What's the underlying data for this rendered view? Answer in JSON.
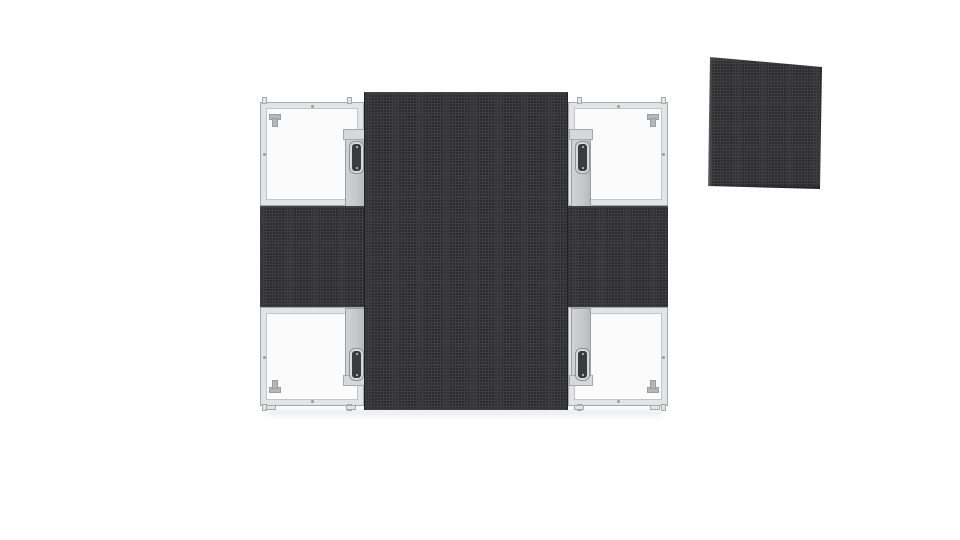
{
  "scene": {
    "type": "product-render",
    "background": "#ffffff",
    "subject": "Front-service LED display cabinet assembly: LED modules arranged in a cross on a 2x2 frame with four empty corner frames, plus one detached LED module shown tilted at the top right"
  },
  "colors": {
    "bg": "#ffffff",
    "led_base": "#2b2b2d",
    "led_grid": "#3e3e40",
    "led_edge": "#1f1f21",
    "frame_fill": "#e3e4e5",
    "frame_edge": "#a6a8aa",
    "frame_inner_line": "#c2c4c6",
    "cell_interior": "#fbfbfc",
    "bracket": "#c6c8ca",
    "bracket_edge": "#9b9da0",
    "handle_slot": "#3a3b3d",
    "handle_ring": "#d8d9da",
    "hook_metal": "#b4b6b8",
    "ground_shadow": "#dcdddd"
  },
  "assembly": {
    "frame_grid": "2x2 cabinets",
    "led_layout": "cross",
    "led_bars": [
      {
        "orientation": "vertical",
        "role": "center-column-modules"
      },
      {
        "orientation": "horizontal",
        "role": "center-row-modules"
      }
    ],
    "corner_frames": [
      {
        "position": "top-left",
        "state": "empty",
        "parts": [
          "hanging-hook",
          "mounting-bracket",
          "lift-handle"
        ]
      },
      {
        "position": "top-right",
        "state": "empty",
        "parts": [
          "hanging-hook",
          "mounting-bracket",
          "lift-handle"
        ]
      },
      {
        "position": "bottom-left",
        "state": "empty",
        "parts": [
          "hanging-hook",
          "mounting-bracket",
          "lift-handle"
        ]
      },
      {
        "position": "bottom-right",
        "state": "empty",
        "parts": [
          "hanging-hook",
          "mounting-bracket",
          "lift-handle"
        ]
      }
    ]
  },
  "detached_module": {
    "position": "top-right-of-image",
    "appearance": "bare LED module face, slightly tilted clockwise"
  }
}
